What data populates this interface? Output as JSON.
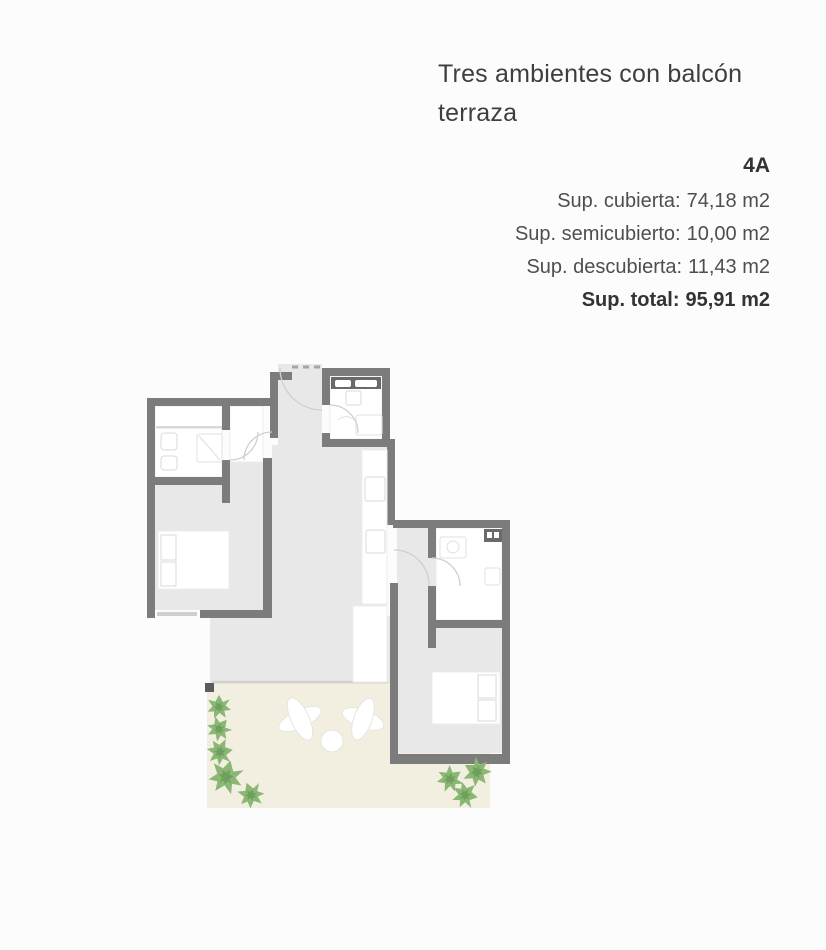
{
  "page": {
    "background": "#fcfcfc"
  },
  "listing": {
    "title": "Tres ambientes con balcón terraza",
    "unit": "4A",
    "surfaces": [
      {
        "label": "Sup. cubierta:",
        "value": "74,18 m2"
      },
      {
        "label": "Sup. semicubierto:",
        "value": "10,00 m2"
      },
      {
        "label": "Sup. descubierta:",
        "value": "11,43 m2"
      },
      {
        "label": "Sup. total:",
        "value": "95,91 m2"
      }
    ]
  },
  "floorplan": {
    "colors": {
      "pageBg": "#fcfcfc",
      "wall": "#7c7c7c",
      "floor": "#e8e8e8",
      "terrace": "#f2efe1",
      "plant": "#8ab874",
      "plantDark": "#6e9f5c",
      "fixtureDark": "#6a6a6a",
      "arc": "#cfcfcf",
      "white": "#ffffff"
    }
  }
}
